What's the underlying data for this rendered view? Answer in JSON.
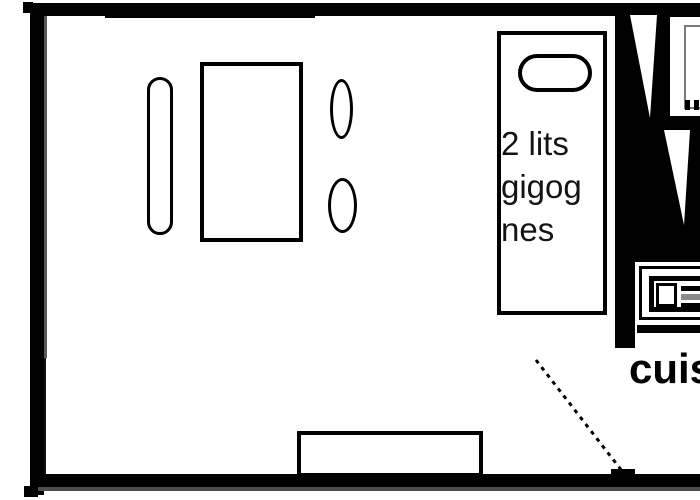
{
  "diagram": {
    "type": "apartment-floor-plan",
    "bed_label_lines": [
      "2 lits",
      "gigog",
      "nes"
    ],
    "kitchen_label": "cuis",
    "elements": [
      "bench",
      "dining-table",
      "chair",
      "chair",
      "trundle-beds-block",
      "pillow",
      "stairs",
      "appliance",
      "kitchen-counter",
      "sink",
      "window-seat",
      "door-swing"
    ]
  },
  "colors": {
    "wall": "#000000",
    "background": "#ffffff",
    "wall_shadow": "#4d4d4d",
    "wall_inner_gray": "#5a5a5a",
    "appliance_inner_border": "#7a7a7a",
    "counter_stripe_gray": "#8a8a8a"
  }
}
